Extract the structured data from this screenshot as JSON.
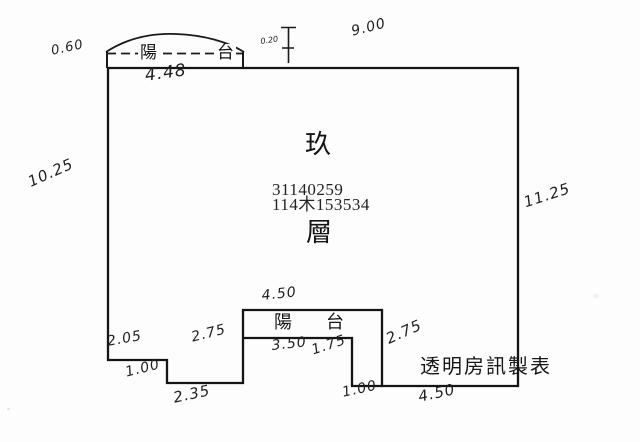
{
  "page": {
    "background": "#fdfdfd",
    "ink": "#1b1b1b"
  },
  "unit": {
    "floor_char_top": "玖",
    "serial_1": "31140259",
    "serial_2": "114木153534",
    "floor_char_bottom": "層"
  },
  "top_balcony": {
    "char1": "陽",
    "char2": "台"
  },
  "bottom_balcony": {
    "char1": "陽",
    "char2": "台"
  },
  "credit": {
    "text": "透明房訊製表"
  },
  "dims": {
    "top_balcony_depth": "0.60",
    "top_balcony_width": "4.48",
    "parapet_thickness": "0.20",
    "top_edge_width": "9.00",
    "left_side_height": "10.25",
    "right_side_height": "11.25",
    "bottom_balcony_width": "4.50",
    "bottom_left_width": "2.05",
    "bottom_balcony_left_height": "2.75",
    "bottom_balcony_inner_width": "3.50",
    "bottom_balcony_inner_height": "1.75",
    "bottom_balcony_right_height": "2.75",
    "bottom_left_step_height": "1.00",
    "bottom_inset_width": "2.35",
    "bottom_balcony_gap_width": "1.00",
    "bottom_right_width": "4.50"
  }
}
